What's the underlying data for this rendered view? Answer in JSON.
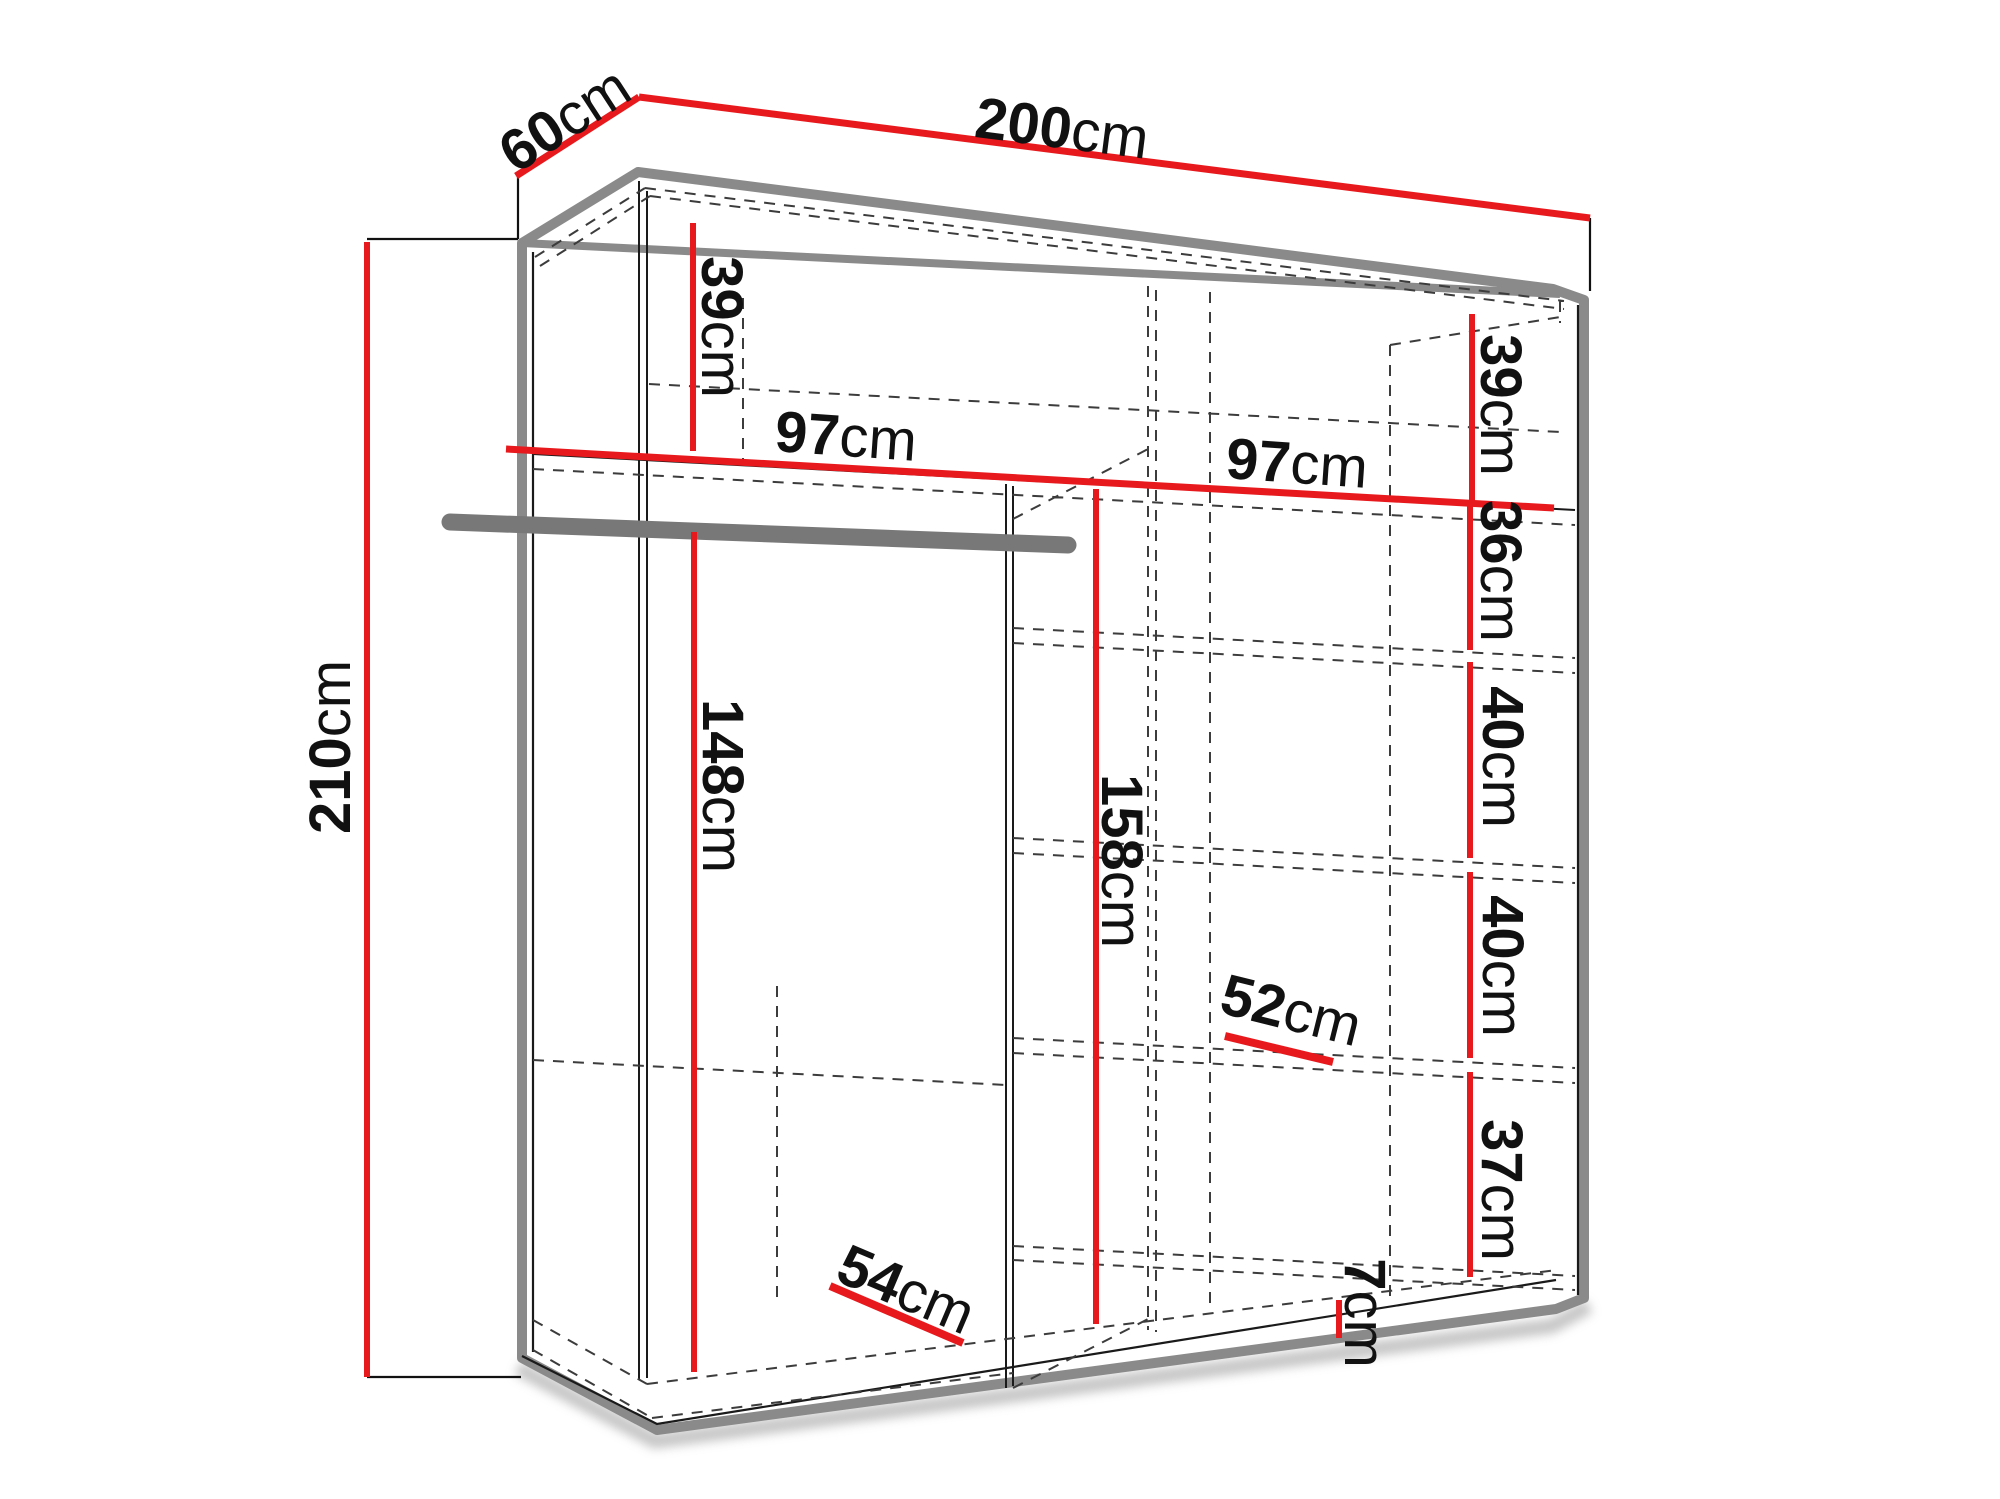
{
  "diagram": {
    "kind": "wardrobe-dimensions-drawing",
    "colors": {
      "dimension_red": "#e8191d",
      "cabinet_gray": "#8a8a8a",
      "rod_gray": "#787878",
      "hidden_edge_gray": "#3c3c3c",
      "text_black": "#111111"
    }
  },
  "labels": {
    "height": {
      "num": "210",
      "unit": "cm"
    },
    "depth": {
      "num": "60",
      "unit": "cm"
    },
    "width": {
      "num": "200",
      "unit": "cm"
    },
    "top_left": {
      "num": "39",
      "unit": "cm"
    },
    "top_right": {
      "num": "39",
      "unit": "cm"
    },
    "left_width": {
      "num": "97",
      "unit": "cm"
    },
    "right_width": {
      "num": "97",
      "unit": "cm"
    },
    "gap_36": {
      "num": "36",
      "unit": "cm"
    },
    "gap_40a": {
      "num": "40",
      "unit": "cm"
    },
    "gap_40b": {
      "num": "40",
      "unit": "cm"
    },
    "gap_37": {
      "num": "37",
      "unit": "cm"
    },
    "hang_space": {
      "num": "148",
      "unit": "cm"
    },
    "mid_space": {
      "num": "158",
      "unit": "cm"
    },
    "shelf_depth": {
      "num": "52",
      "unit": "cm"
    },
    "floor_depth": {
      "num": "54",
      "unit": "cm"
    },
    "plinth": {
      "num": "7",
      "unit": "cm"
    }
  }
}
